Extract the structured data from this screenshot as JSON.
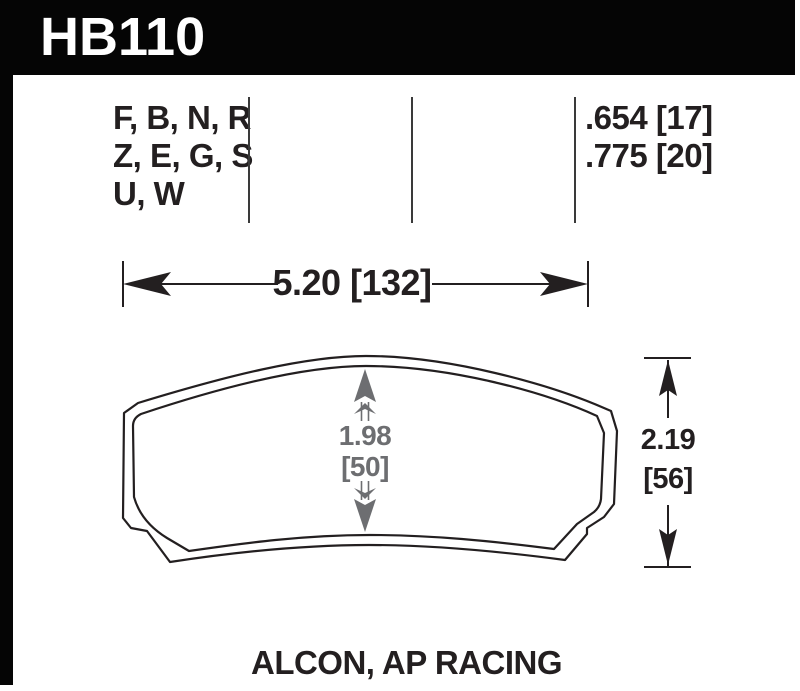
{
  "header": {
    "part_number": "HB110"
  },
  "compounds": {
    "rows": [
      "F, B, N, R",
      "Z, E, G, S",
      "U, W"
    ]
  },
  "pad_thickness": {
    "rows": [
      ".654 [17]",
      ".775 [20]"
    ]
  },
  "dimensions": {
    "width": "5.20 [132]",
    "center_height": {
      "line1": "1.98",
      "line2": "[50]"
    },
    "overall_height": {
      "line1": "2.19",
      "line2": "[56]"
    }
  },
  "footer": {
    "applications": "ALCON, AP RACING"
  },
  "colors": {
    "ink": "#231f20",
    "dimension_gray": "#6d6e71",
    "header_bg": "#050505",
    "paper": "#ffffff",
    "header_text": "#ffffff"
  }
}
